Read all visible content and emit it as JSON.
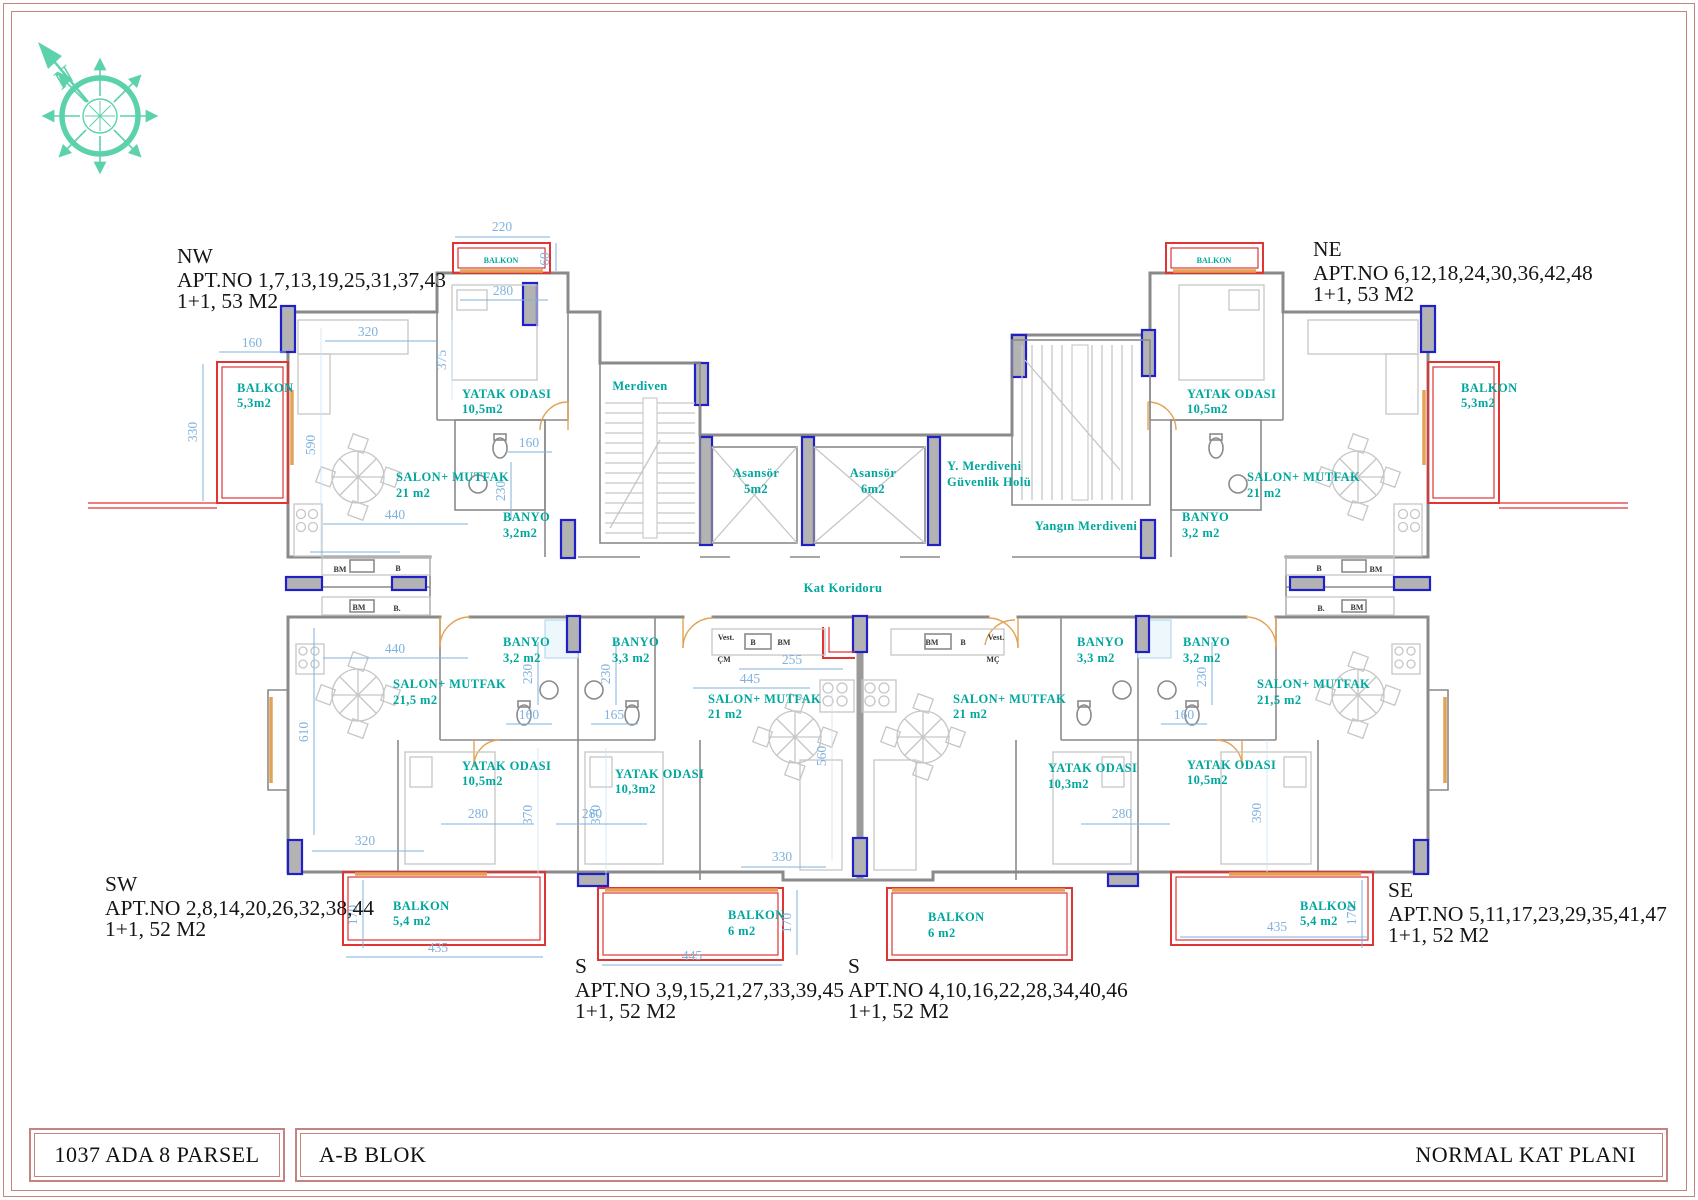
{
  "title_block": {
    "parcel": "1037 ADA 8 PARSEL",
    "block": "A-B BLOK",
    "plan": "NORMAL KAT PLANI"
  },
  "compass": {
    "north": "N"
  },
  "apartments": {
    "nw": {
      "region": "NW",
      "apt_no": "APT.NO 1,7,13,19,25,31,37,43",
      "type": "1+1, 53 M2"
    },
    "ne": {
      "region": "NE",
      "apt_no": "APT.NO 6,12,18,24,30,36,42,48",
      "type": "1+1, 53 M2"
    },
    "sw": {
      "region": "SW",
      "apt_no": "APT.NO 2,8,14,20,26,32,38,44",
      "type": "1+1, 52 M2"
    },
    "se": {
      "region": "SE",
      "apt_no": "APT.NO 5,11,17,23,29,35,41,47",
      "type": "1+1, 52 M2"
    },
    "s1": {
      "region": "S",
      "apt_no": "APT.NO 3,9,15,21,27,33,39,45",
      "type": "1+1, 52 M2"
    },
    "s2": {
      "region": "S",
      "apt_no": "APT.NO 4,10,16,22,28,34,40,46",
      "type": "1+1, 52 M2"
    }
  },
  "rooms": {
    "yatak_odasi": "YATAK ODASI",
    "salon_mutfak": "SALON+ MUTFAK",
    "banyo": "BANYO",
    "balkon": "BALKON",
    "merdiven": "Merdiven",
    "asansor": "Asansör",
    "guvenlik_line1": "Y. Merdiveni",
    "guvenlik_line2": "Güvenlik Holü",
    "yangin_merdiveni": "Yangın Merdiveni",
    "kat_koridoru": "Kat Koridoru",
    "vest": "Vest.",
    "cm": "ÇM",
    "mc": "MÇ",
    "b": "B",
    "bm": "BM",
    "b_dot": "B."
  },
  "areas": {
    "a10_5": "10,5m2",
    "a10_3": "10,3m2",
    "a21": "21 m2",
    "a21_5": "21,5 m2",
    "a3_2": "3,2 m2",
    "a3_2c": "3,2m2",
    "a3_3": "3,3 m2",
    "a5_3": "5,3m2",
    "a5_4": "5,4 m2",
    "a6": "6 m2",
    "a5": "5m2",
    "a6m": "6m2"
  },
  "dims": {
    "d60": "60",
    "d160": "160",
    "d165": "165",
    "d170": "170",
    "d220": "220",
    "d230": "230",
    "d255": "255",
    "d265": "265",
    "d280": "280",
    "d320": "320",
    "d330": "330",
    "d370": "370",
    "d375": "375",
    "d390": "390",
    "d435": "435",
    "d440": "440",
    "d445": "445",
    "d560": "560",
    "d590": "590",
    "d610": "610"
  },
  "colors": {
    "accent": "#00a79d",
    "dim": "#7fb2de",
    "rail": "#e03535",
    "window": "#e2a355",
    "column": "#2020c8",
    "compass": "#5bd1ac",
    "frame": "#c4837e",
    "wall": "#8a8a8a",
    "furn": "#c6c6c6"
  }
}
